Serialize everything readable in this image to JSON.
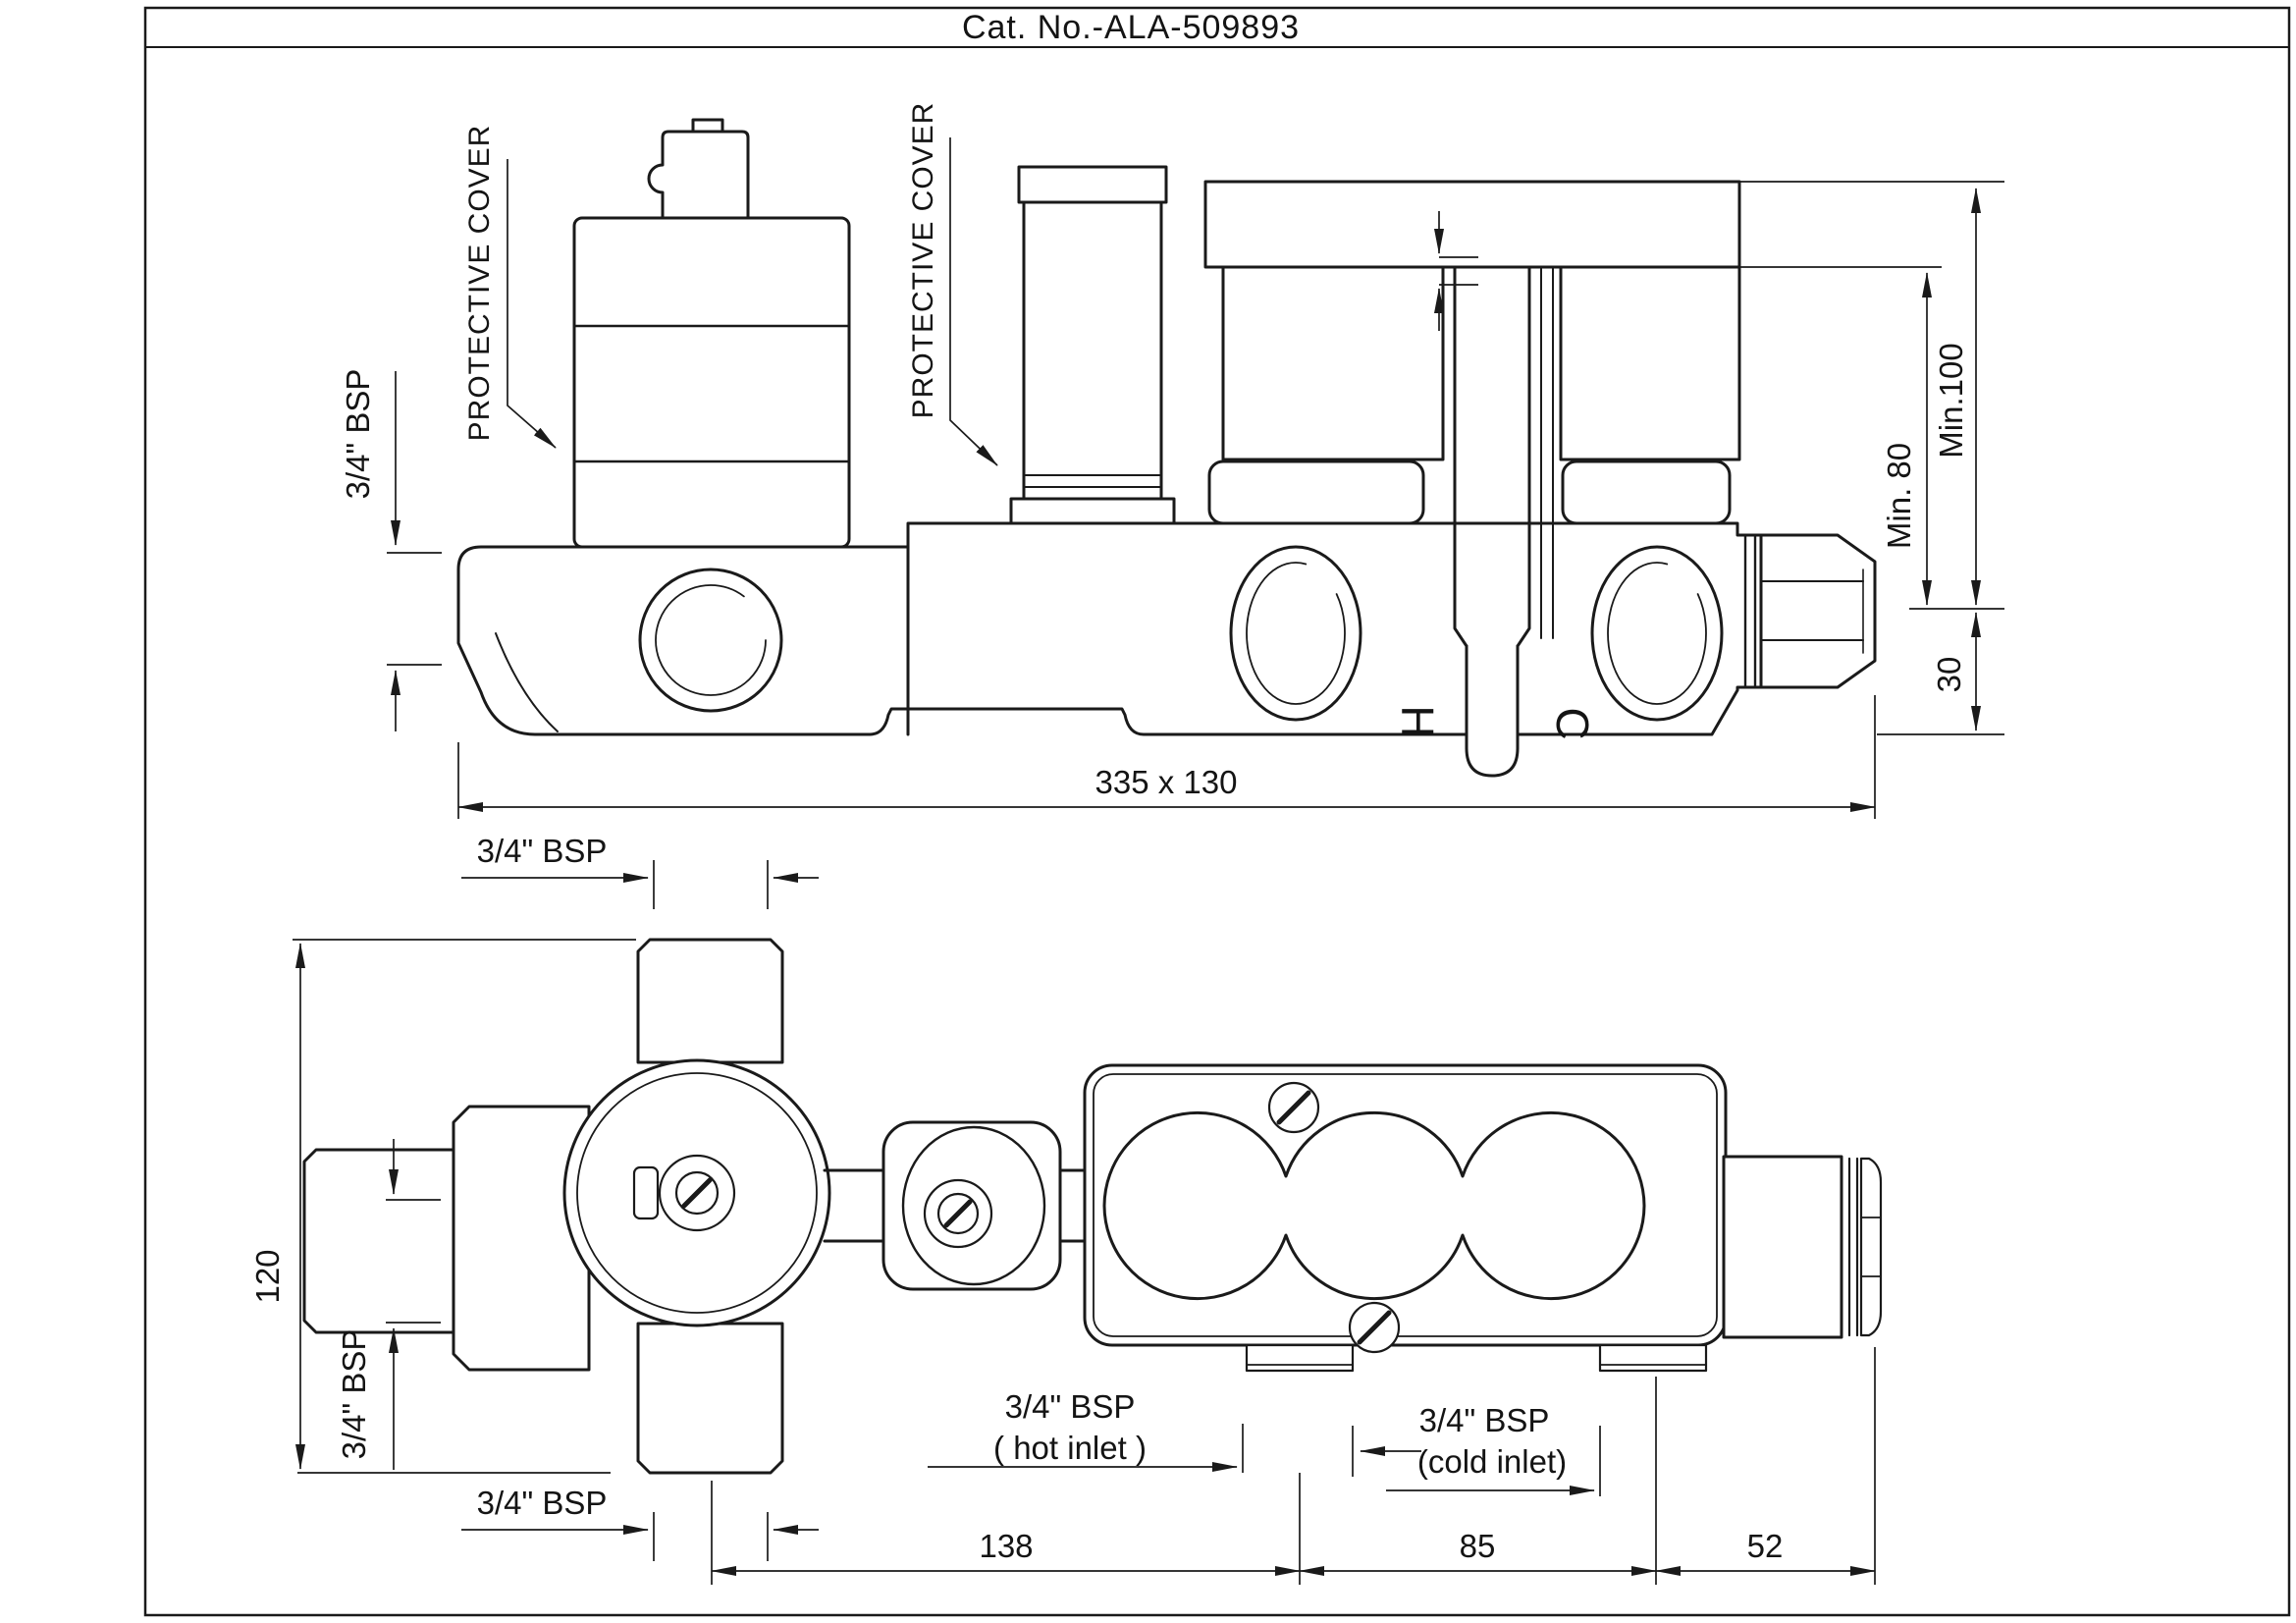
{
  "title": "Cat. No.-ALA-509893",
  "colors": {
    "line": "#1a1a1a",
    "background": "#ffffff"
  },
  "top_view": {
    "protective_cover_left_label": "PROTECTIVE COVER",
    "protective_cover_mid_label": "PROTECTIVE COVER",
    "bsp_left_bore": "3/4\" BSP",
    "hot_port_marker": "H",
    "cold_port_marker": "C",
    "dim_overall": "335 x 130",
    "dim_min_80": "Min. 80",
    "dim_min_100": "Min.100",
    "dim_30": "30"
  },
  "bottom_view": {
    "bsp_top_bore": "3/4\" BSP",
    "dim_120": "120",
    "bsp_arm_bore": "3/4\" BSP",
    "bsp_bottom_bore": "3/4\" BSP",
    "hot_inlet_line1": "3/4\" BSP",
    "hot_inlet_line2": "( hot inlet )",
    "cold_inlet_line1": "3/4\" BSP",
    "cold_inlet_line2": "(cold inlet)",
    "dim_138": "138",
    "dim_85": "85",
    "dim_52": "52"
  }
}
